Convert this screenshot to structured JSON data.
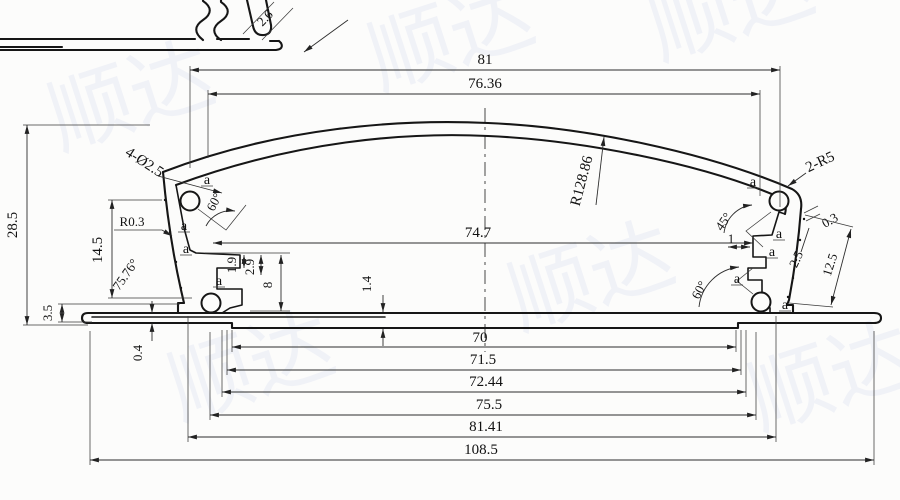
{
  "drawing": {
    "detail_view": {
      "thickness": "2.6"
    },
    "top_dims": {
      "overall_width": "81",
      "lid_width": "76.36",
      "cavity_width": "74.7"
    },
    "left_dims": {
      "total_height": "28.5",
      "side_height": "14.5",
      "base_height": "3.5",
      "base_lip": "0.4",
      "floor_thickness": "1.4",
      "corner_radius": "R0.3",
      "screw_holes": "4-Ø2.5",
      "wall_angle": "75.76°",
      "boss_angle": "60°",
      "slot_depth_a": "1.9",
      "slot_depth_b": "2.9",
      "slot_height": "8"
    },
    "right_dims": {
      "dome_radius": "R128.86",
      "corner_radius": "2-R5",
      "boss_angle_top": "45°",
      "serration_step": "0.3",
      "groove_pitch": "2.5",
      "face_length": "12.5",
      "boss_angle_bottom": "60°",
      "tab_width": "1"
    },
    "bottom_dims": [
      "70",
      "71.5",
      "72.44",
      "75.5",
      "81.41",
      "108.5"
    ],
    "ref_marker": "a",
    "watermark": {
      "text": "顺达",
      "color": "#e8eaf4"
    }
  }
}
